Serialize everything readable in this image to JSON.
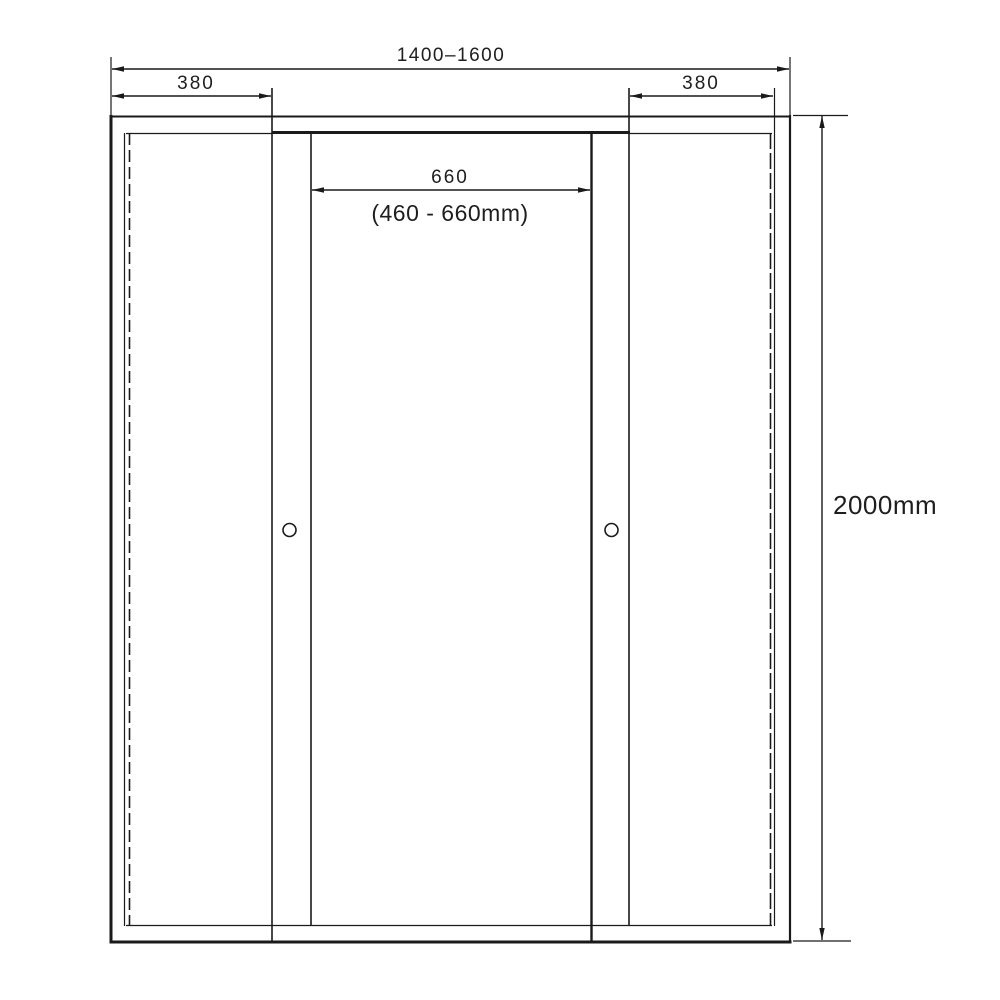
{
  "drawing": {
    "labels": {
      "overall_width": "1400–1600",
      "left_panel_width": "380",
      "right_panel_width": "380",
      "opening_width": "660",
      "opening_range": "(460 - 660mm)",
      "overall_height": "2000mm"
    },
    "colors": {
      "line": "#1a1a1a",
      "background": "#ffffff"
    }
  }
}
